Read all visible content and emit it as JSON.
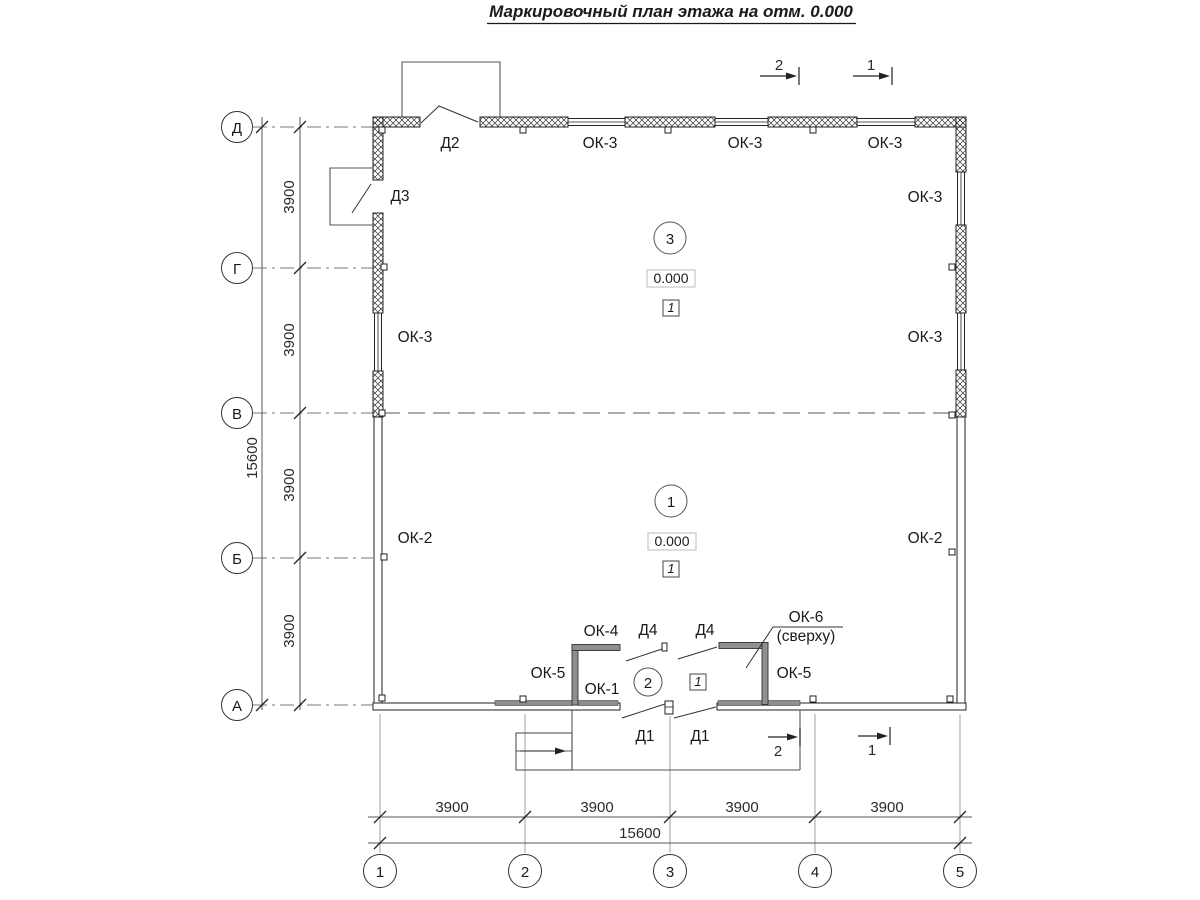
{
  "title": "Маркировочный план этажа на отм. 0.000",
  "palette": {
    "ink": "#1a1a1a",
    "secondary": "#555555",
    "partition_fill": "#8f8f8f"
  },
  "axes": {
    "vertical": [
      "Д",
      "Г",
      "В",
      "Б",
      "А"
    ],
    "horizontal": [
      "1",
      "2",
      "3",
      "4",
      "5"
    ]
  },
  "dimensions": {
    "left_segments": [
      "3900",
      "3900",
      "3900",
      "3900"
    ],
    "left_total": "15600",
    "bottom_segments": [
      "3900",
      "3900",
      "3900",
      "3900"
    ],
    "bottom_total": "15600"
  },
  "sections": {
    "top": [
      "2",
      "1"
    ],
    "bottom": [
      "2",
      "1"
    ]
  },
  "rooms": {
    "room3": {
      "number": "3",
      "elevation": "0.000",
      "floor_type": "1"
    },
    "room1": {
      "number": "1",
      "elevation": "0.000",
      "floor_type": "1"
    },
    "room2": {
      "number": "2",
      "floor_type": "1"
    }
  },
  "windows": {
    "top": [
      "ОК-3",
      "ОК-3",
      "ОК-3"
    ],
    "right": [
      "ОК-3",
      "ОК-3",
      "ОК-2"
    ],
    "left": [
      "ОК-3",
      "ОК-2"
    ],
    "ok4": "ОК-4",
    "ok5_left": "ОК-5",
    "ok5_right": "ОК-5",
    "ok1": "ОК-1",
    "ok6": "ОК-6",
    "ok6_note": "(сверху)"
  },
  "doors": {
    "d1_left": "Д1",
    "d1_right": "Д1",
    "d2": "Д2",
    "d3": "Д3",
    "d4_left": "Д4",
    "d4_right": "Д4"
  }
}
